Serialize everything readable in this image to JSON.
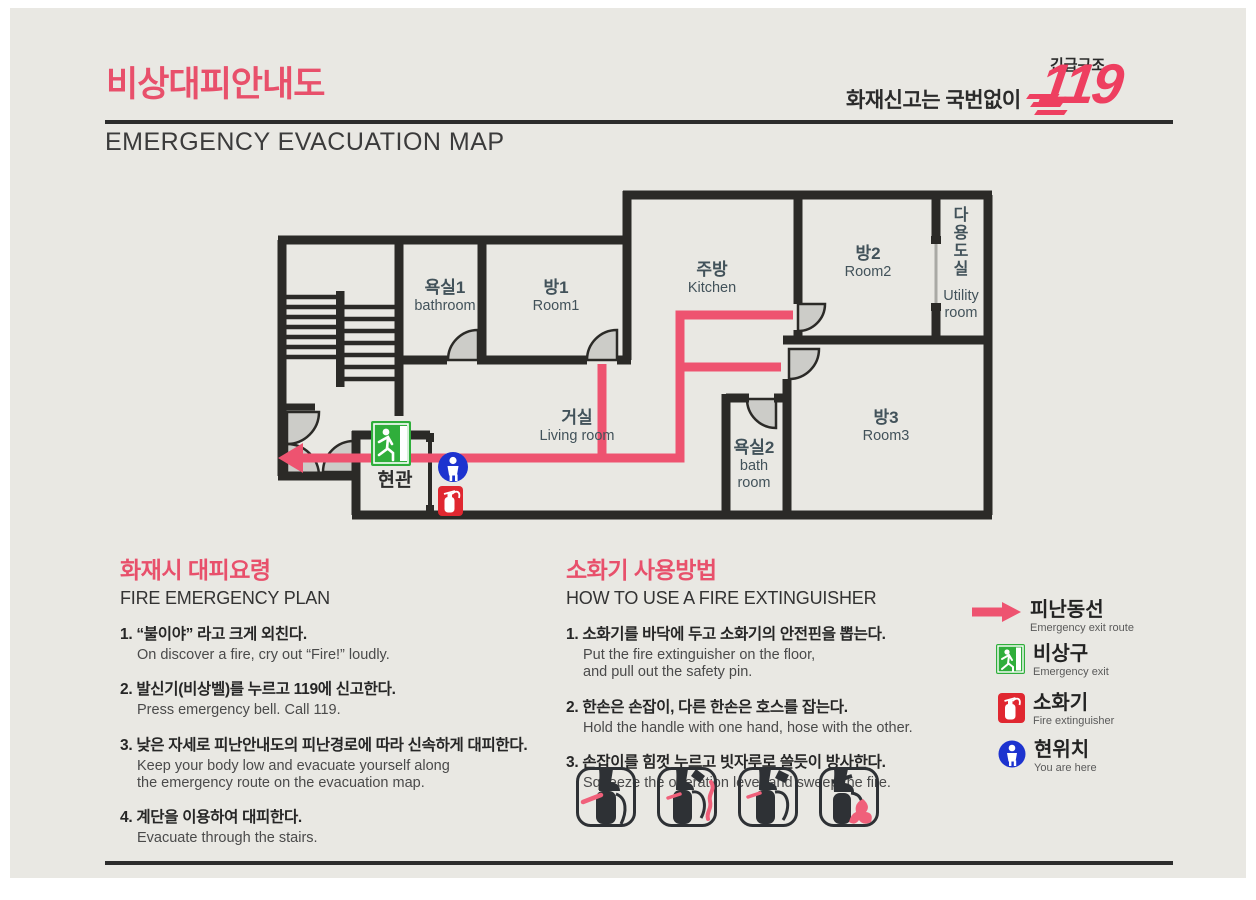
{
  "header": {
    "title_ko": "비상대피안내도",
    "title_en": "EMERGENCY EVACUATION MAP",
    "fire_call": "화재신고는 국번없이",
    "rescue_label": "긴급구조",
    "emergency_number": "119"
  },
  "floorplan": {
    "rooms": {
      "bathroom1": {
        "ko": "욕실1",
        "en": "bathroom"
      },
      "room1": {
        "ko": "방1",
        "en": "Room1"
      },
      "kitchen": {
        "ko": "주방",
        "en": "Kitchen"
      },
      "room2": {
        "ko": "방2",
        "en": "Room2"
      },
      "utility": {
        "ko": "다용도실",
        "en": "Utility\nroom"
      },
      "living": {
        "ko": "거실",
        "en": "Living room"
      },
      "bathroom2": {
        "ko": "욕실2",
        "en": "bath\nroom"
      },
      "room3": {
        "ko": "방3",
        "en": "Room3"
      },
      "entrance": {
        "ko": "현관"
      }
    }
  },
  "fire_plan": {
    "heading_ko": "화재시 대피요령",
    "heading_en": "FIRE EMERGENCY PLAN",
    "items": [
      {
        "ko": "1. “불이야” 라고 크게 외친다.",
        "en": "On discover a fire, cry out “Fire!” loudly."
      },
      {
        "ko": "2. 발신기(비상벨)를 누르고 119에 신고한다.",
        "en": "Press emergency bell. Call 119."
      },
      {
        "ko": "3. 낮은 자세로 피난안내도의 피난경로에 따라 신속하게 대피한다.",
        "en": "Keep your body low and evacuate yourself along\nthe emergency route on the evacuation map."
      },
      {
        "ko": "4. 계단을 이용하여 대피한다.",
        "en": "Evacuate through the stairs."
      }
    ]
  },
  "extinguisher_guide": {
    "heading_ko": "소화기 사용방법",
    "heading_en": "HOW TO USE A FIRE EXTINGUISHER",
    "items": [
      {
        "ko": "1. 소화기를 바닥에 두고 소화기의 안전핀을 뽑는다.",
        "en": "Put the fire extinguisher on the floor,\nand pull out the safety pin."
      },
      {
        "ko": "2. 한손은 손잡이, 다른 한손은 호스를 잡는다.",
        "en": "Hold the handle with one hand, hose with the other."
      },
      {
        "ko": "3. 손잡이를 힘껏 누르고 빗자루로 쓸듯이 방사한다.",
        "en": "Squeeze the operation lever and sweep the fire."
      }
    ],
    "steps_illustrations": 4
  },
  "legend": {
    "items": [
      {
        "ko": "피난동선",
        "en": "Emergency exit route",
        "icon": "route-arrow"
      },
      {
        "ko": "비상구",
        "en": "Emergency exit",
        "icon": "emergency-exit-sign"
      },
      {
        "ko": "소화기",
        "en": "Fire extinguisher",
        "icon": "fire-extinguisher"
      },
      {
        "ko": "현위치",
        "en": "You are here",
        "icon": "you-are-here"
      }
    ]
  },
  "colors": {
    "accent_pink": "#ee5370",
    "wall_dark": "#2b2a27",
    "exit_green": "#2fae3b",
    "extinguisher_red": "#e02730",
    "here_blue": "#1d33cf",
    "background": "#e9e8e3"
  }
}
